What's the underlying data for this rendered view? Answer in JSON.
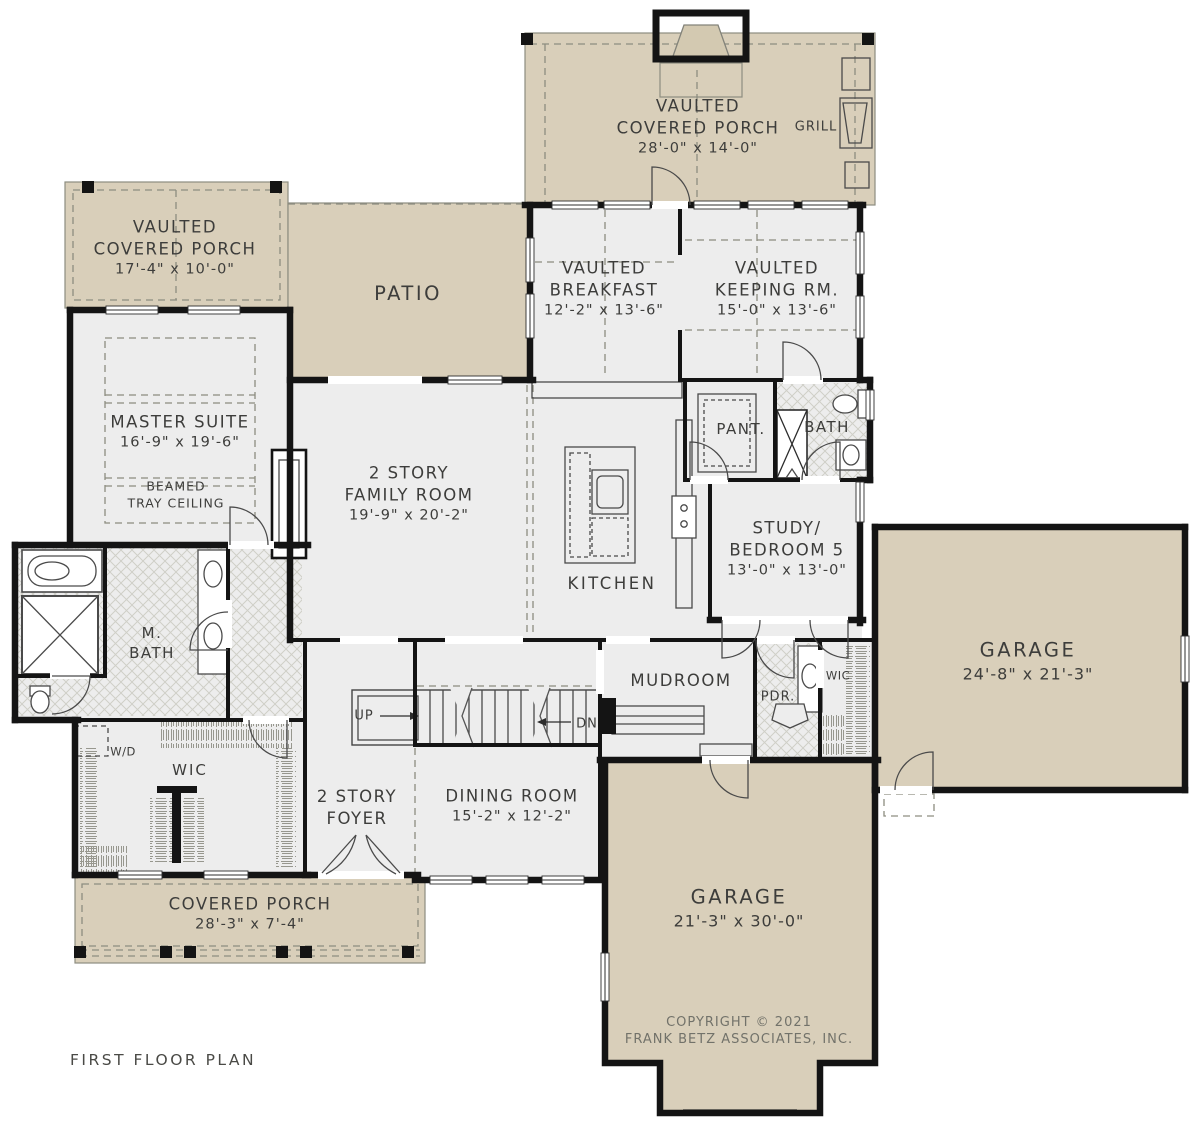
{
  "plan_title": "FIRST FLOOR PLAN",
  "colors": {
    "porch_fill": "#d9cfba",
    "room_fill": "#ededed",
    "wall": "#141414",
    "text": "#3d3d3b",
    "copyright_text": "#72726a"
  },
  "labels": {
    "top_porch": [
      "VAULTED",
      "COVERED PORCH",
      "28'-0\" x 14'-0\""
    ],
    "grill": "GRILL",
    "left_porch": [
      "VAULTED",
      "COVERED PORCH",
      "17'-4\" x 10'-0\""
    ],
    "patio": "PATIO",
    "breakfast": [
      "VAULTED",
      "BREAKFAST",
      "12'-2\" x 13'-6\""
    ],
    "keeping": [
      "VAULTED",
      "KEEPING RM.",
      "15'-0\" x 13'-6\""
    ],
    "master": [
      "MASTER SUITE",
      "16'-9\" x 19'-6\""
    ],
    "master_note": [
      "BEAMED",
      "TRAY CEILING"
    ],
    "family": [
      "2 STORY",
      "FAMILY ROOM",
      "19'-9\" x 20'-2\""
    ],
    "kitchen": "KITCHEN",
    "pantry": "PANT.",
    "bath": "BATH",
    "study": [
      "STUDY/",
      "BEDROOM 5",
      "13'-0\" x 13'-0\""
    ],
    "mbath": [
      "M.",
      "BATH"
    ],
    "wd": "W/D",
    "wic": "WIC",
    "foyer": [
      "2 STORY",
      "FOYER"
    ],
    "up": "UP",
    "dn": "DN",
    "dining": [
      "DINING ROOM",
      "15'-2\" x 12'-2\""
    ],
    "mudroom": "MUDROOM",
    "pdr": "PDR.",
    "wic2": "WIC",
    "garage_side": [
      "GARAGE",
      "24'-8\" x 21'-3\""
    ],
    "garage_front": [
      "GARAGE",
      "21'-3\" x 30'-0\""
    ],
    "covered_porch": [
      "COVERED PORCH",
      "28'-3\" x 7'-4\""
    ],
    "copyright": [
      "COPYRIGHT © 2021",
      "FRANK BETZ ASSOCIATES, INC."
    ]
  }
}
